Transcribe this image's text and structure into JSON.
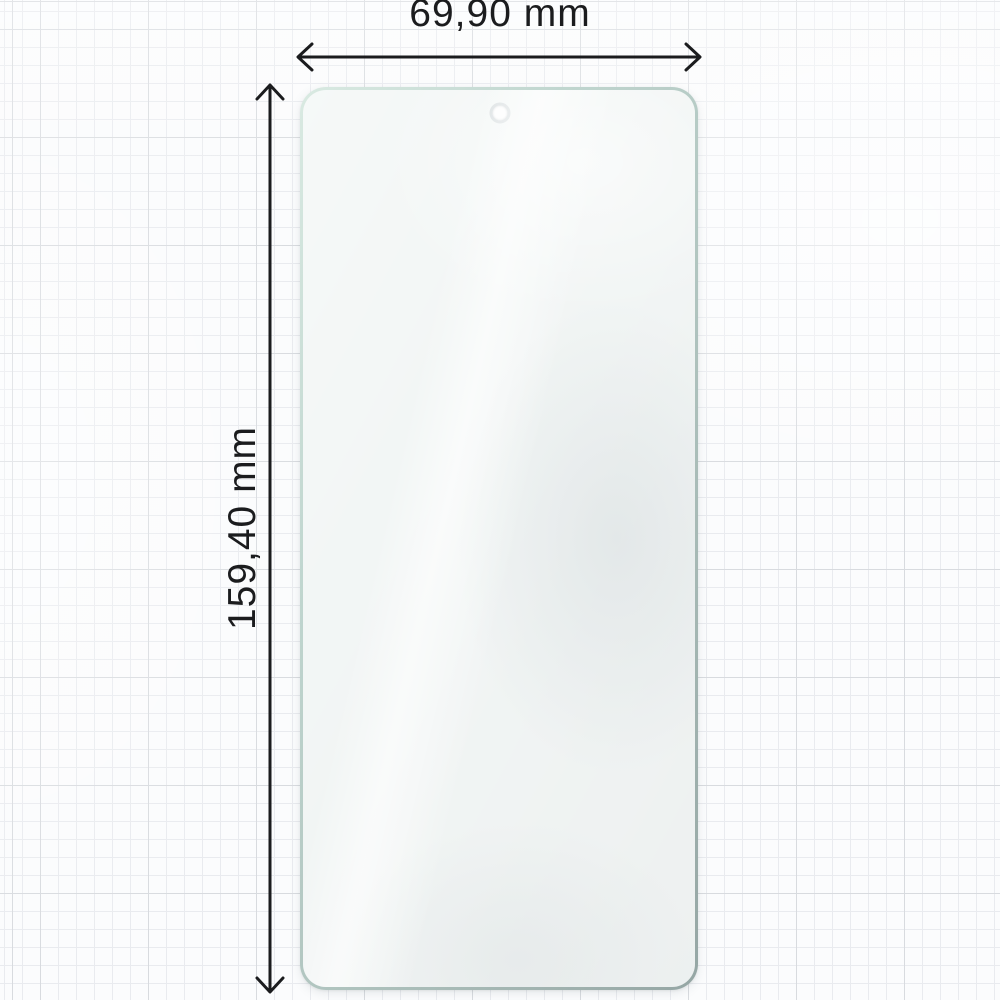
{
  "scene": {
    "width_dimension": {
      "label": "69,90 mm"
    },
    "height_dimension": {
      "label": "159,40 mm"
    },
    "film": {
      "camera_hole": "punch-hole-top-center"
    },
    "colors": {
      "ink": "#1b1c1e",
      "paper": "#fbfcfd",
      "grid_minor": "#e9ebef",
      "grid_major": "#d8dbdf",
      "edge_light": "#d9eae2",
      "edge_mid": "#c0d6cf",
      "edge_dark": "#95a6a4",
      "film_fill": "#f9fafb"
    }
  }
}
